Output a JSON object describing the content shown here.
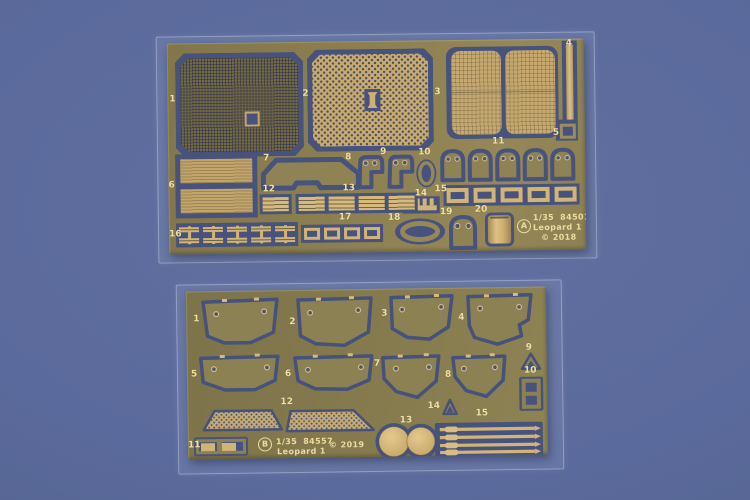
{
  "colors": {
    "background": "#5b6a9c",
    "sheet_brass": "#897c4f",
    "etched_gap": "#47527d",
    "half_etch_brass": "#cdb073",
    "label_cream": "#efdfa2"
  },
  "sheet_a": {
    "badge": "A",
    "marking": {
      "scale": "1/35",
      "code": "84501",
      "name": "Leopard 1",
      "copyright": "© 2018"
    },
    "parts": [
      {
        "label": "1"
      },
      {
        "label": "2"
      },
      {
        "label": "3"
      },
      {
        "label": "4"
      },
      {
        "label": "5"
      },
      {
        "label": "6"
      },
      {
        "label": "7"
      },
      {
        "label": "8"
      },
      {
        "label": "9"
      },
      {
        "label": "10"
      },
      {
        "label": "11"
      },
      {
        "label": "12"
      },
      {
        "label": "13"
      },
      {
        "label": "14"
      },
      {
        "label": "15"
      },
      {
        "label": "16"
      },
      {
        "label": "17"
      },
      {
        "label": "18"
      },
      {
        "label": "19"
      },
      {
        "label": "20"
      }
    ]
  },
  "sheet_b": {
    "badge": "B",
    "marking": {
      "scale": "1/35",
      "code": "84557",
      "name": "Leopard 1",
      "copyright": "© 2019"
    },
    "parts": [
      {
        "label": "1"
      },
      {
        "label": "2"
      },
      {
        "label": "3"
      },
      {
        "label": "4"
      },
      {
        "label": "5"
      },
      {
        "label": "6"
      },
      {
        "label": "7"
      },
      {
        "label": "8"
      },
      {
        "label": "9"
      },
      {
        "label": "10"
      },
      {
        "label": "11"
      },
      {
        "label": "12"
      },
      {
        "label": "13"
      },
      {
        "label": "14"
      },
      {
        "label": "15"
      }
    ]
  }
}
